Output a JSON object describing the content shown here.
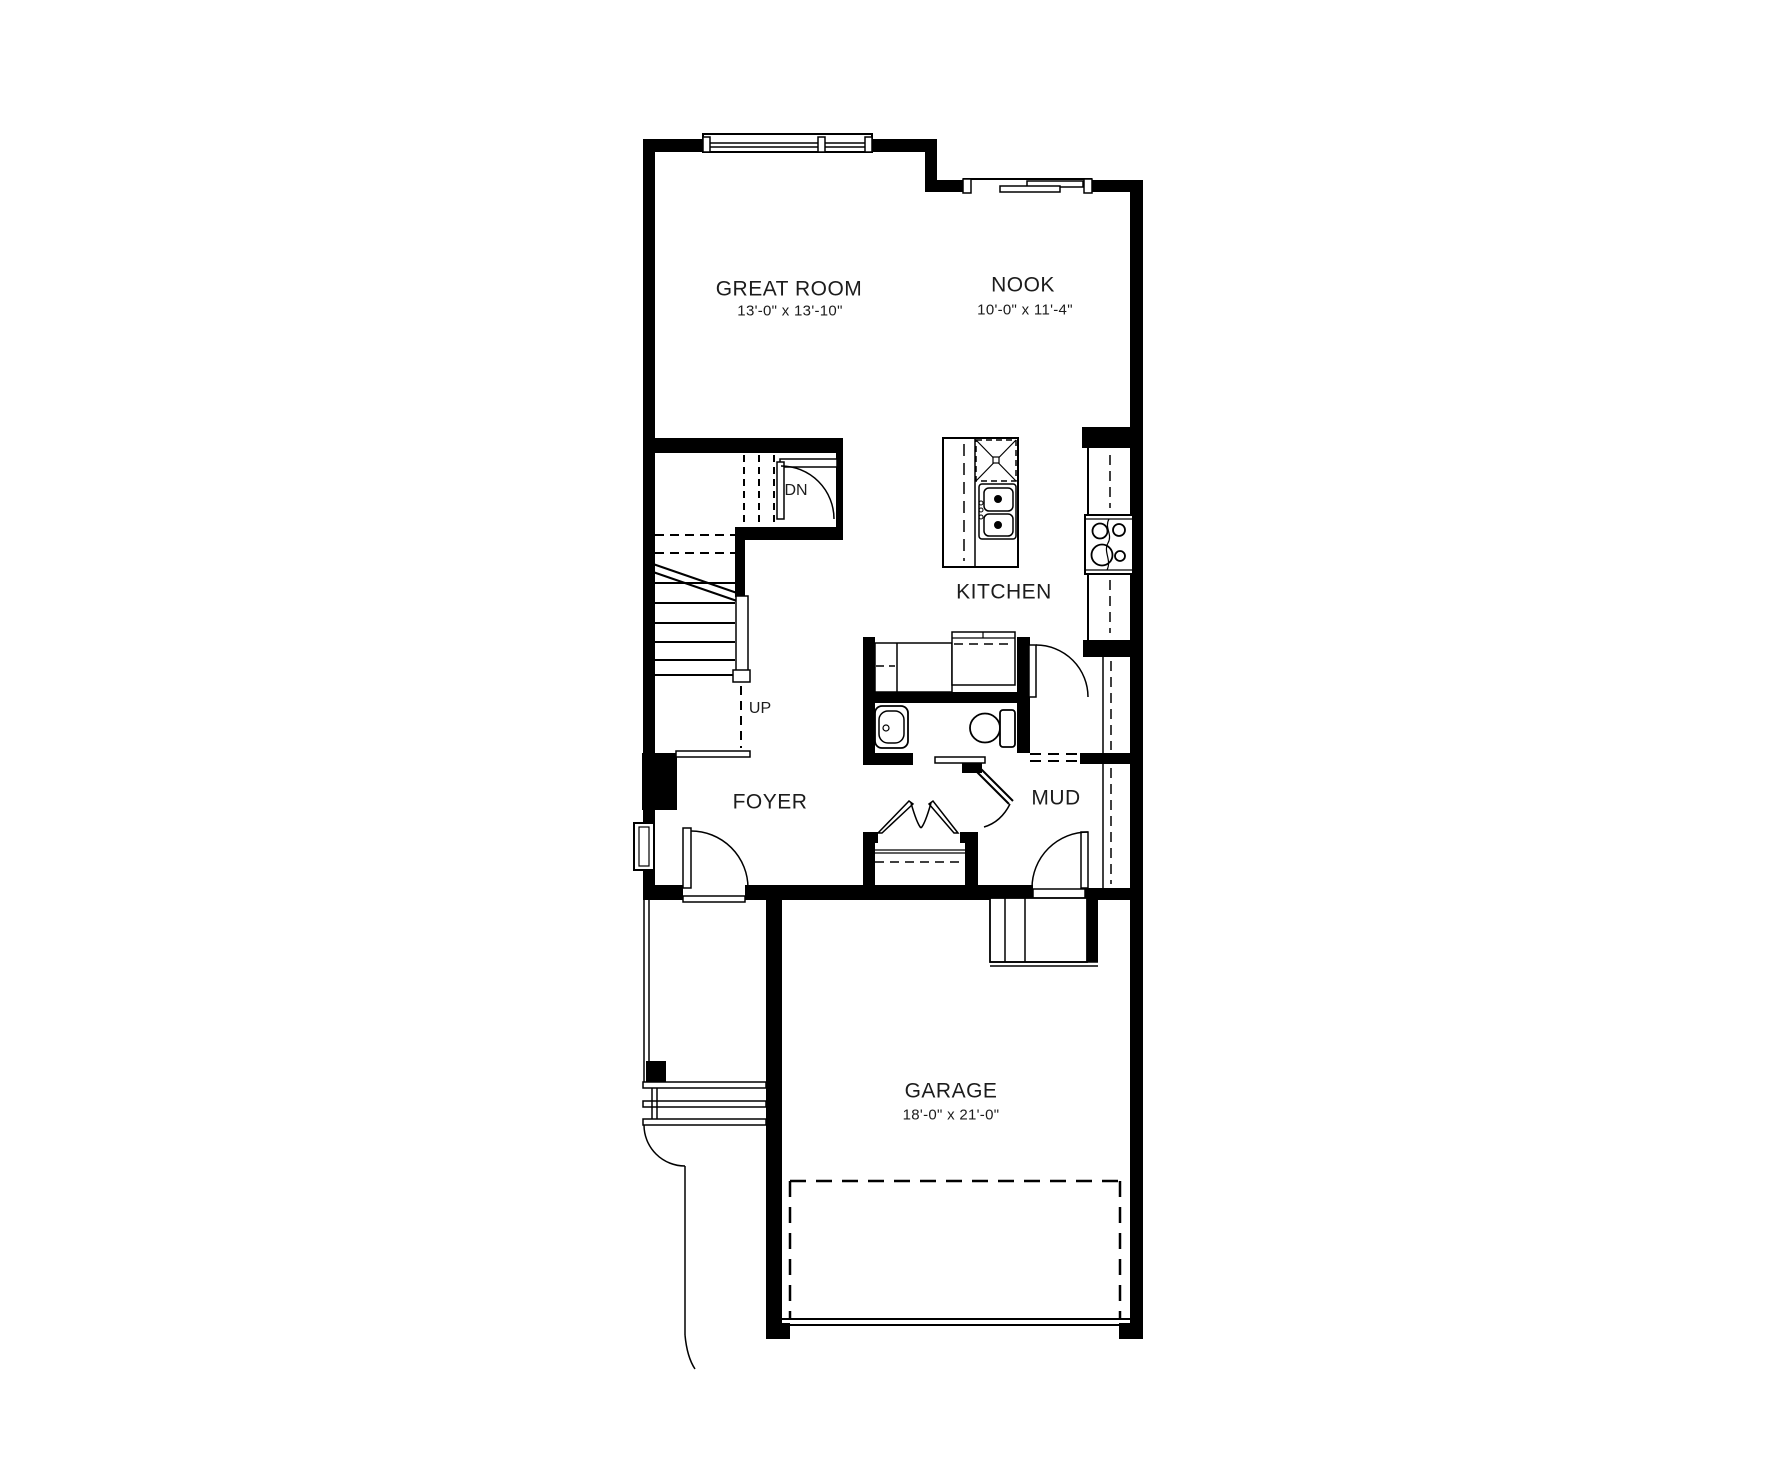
{
  "plan": {
    "type": "floor-plan",
    "background": "#ffffff",
    "wall_color": "#000000",
    "line_color": "#1c1c1c",
    "rooms": {
      "great_room": {
        "label": "GREAT ROOM",
        "dims": "13'-0\" x 13'-10\""
      },
      "nook": {
        "label": "NOOK",
        "dims": "10'-0\" x 11'-4\""
      },
      "kitchen": {
        "label": "KITCHEN"
      },
      "foyer": {
        "label": "FOYER"
      },
      "mud": {
        "label": "MUD"
      },
      "garage": {
        "label": "GARAGE",
        "dims": "18'-0\" x 21'-0\""
      }
    },
    "stairs": {
      "up": "UP",
      "down": "DN"
    },
    "fixtures": [
      "kitchen-island",
      "dishwasher",
      "double-sink",
      "range-cooktop",
      "toilet",
      "vanity-sink",
      "coat-closet-bifold",
      "mud-bench",
      "garage-entry-steps",
      "front-porch-post",
      "garage-door",
      "sliding-window"
    ]
  }
}
